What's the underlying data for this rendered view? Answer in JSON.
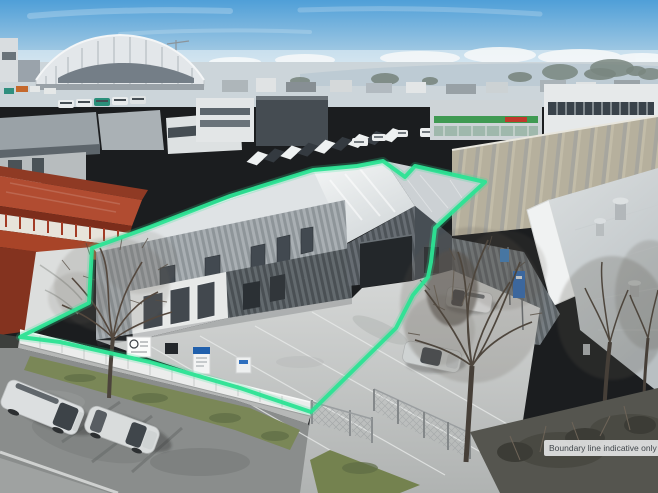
{
  "overlay": {
    "boundary_label": "Boundary line indicative only",
    "boundary_color": "#2ce394",
    "boundary_points": "20,337 89,303 92,248 150,227 230,196 313,170 357,166 383,161 405,177 415,166 485,182 473,193 435,228 431,262 428,277 413,295 396,328 311,412 240,388 150,362 60,342"
  },
  "palette": {
    "sky_top": "#4f9fd8",
    "sky_horizon": "#e9f0f4",
    "red_building_roof": "#b14c31",
    "main_cladding": "#99a0a5",
    "roof_silver": "#e9ecec",
    "concrete_yard": "#c8cac9",
    "street_asphalt": "#8a8d8c",
    "grass_berm": "#7a8757",
    "label_background": "#e9ebec",
    "label_text": "#41474c"
  }
}
